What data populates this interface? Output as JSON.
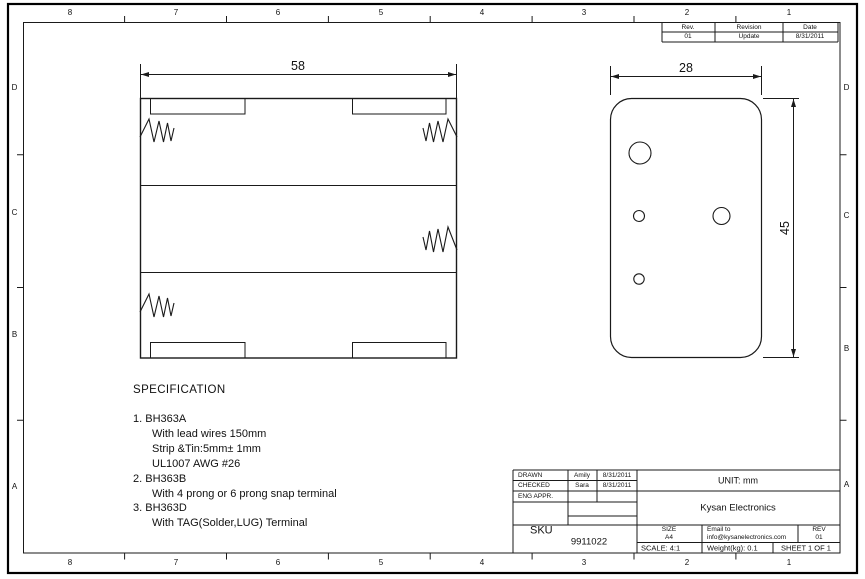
{
  "frame": {
    "columns": [
      "8",
      "7",
      "6",
      "5",
      "4",
      "3",
      "2",
      "1"
    ],
    "rows": [
      "D",
      "C",
      "B",
      "A"
    ]
  },
  "revision_table": {
    "col_rev": "Rev.",
    "col_revision": "Revision",
    "col_date": "Date",
    "val_rev": "01",
    "val_revision": "Update",
    "val_date": "8/31/2011"
  },
  "views": {
    "front_width": "58",
    "side_width": "28",
    "side_height": "45"
  },
  "specification": {
    "title": "SPECIFICATION",
    "lines": [
      "1. BH363A",
      "With lead wires 150mm",
      "Strip &Tin:5mm± 1mm",
      "UL1007 AWG #26",
      "2. BH363B",
      "With 4 prong or 6 prong snap terminal",
      "3. BH363D",
      "With TAG(Solder,LUG) Terminal"
    ]
  },
  "title_block": {
    "drawn_label": "DRAWN",
    "drawn_name": "Amily",
    "drawn_date": "8/31/2011",
    "checked_label": "CHECKED",
    "checked_name": "Sara",
    "checked_date": "8/31/2011",
    "eng_appr_label": "ENG APPR.",
    "unit": "UNIT: mm",
    "company": "Kysan Electronics",
    "sku_label": "SKU",
    "sku_value": "9911022",
    "size_label": "SIZE",
    "size_value": "A4",
    "email_label": "Email to",
    "email_value": "info@kysanelectronics.com",
    "rev_label": "REV",
    "rev_value": "01",
    "scale": "SCALE: 4:1",
    "weight": "Weight(kg): 0.1",
    "sheet": "SHEET 1 OF 1"
  }
}
